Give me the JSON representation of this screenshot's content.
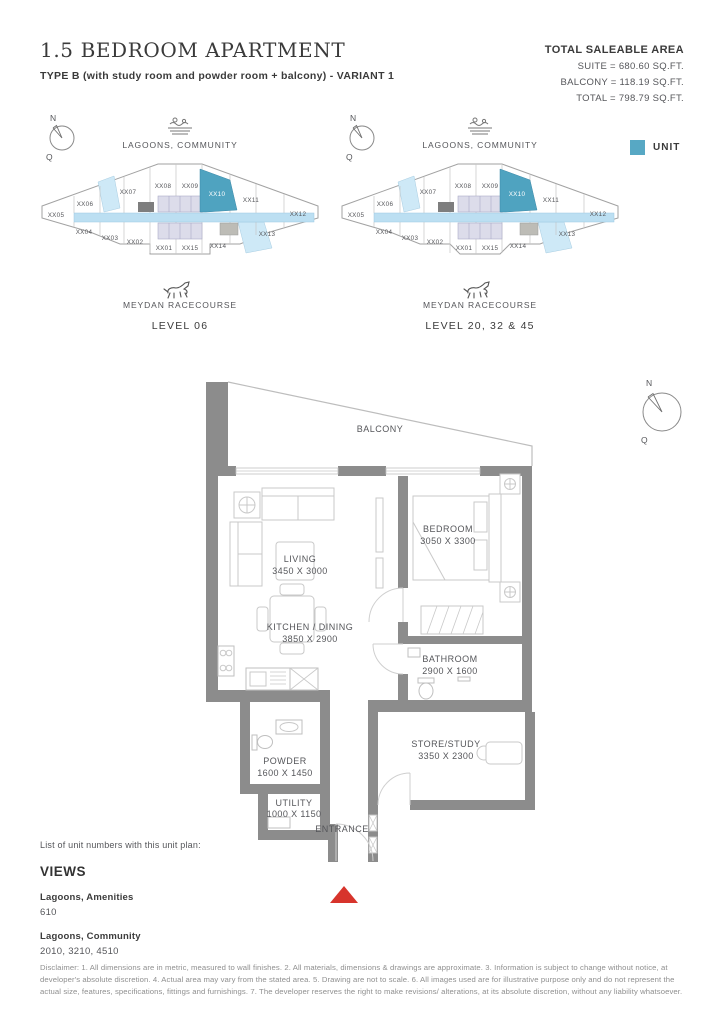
{
  "header": {
    "title": "1.5 BEDROOM APARTMENT",
    "subtitle": "TYPE B (with study room and powder room + balcony) - VARIANT 1",
    "area_heading": "TOTAL SALEABLE AREA",
    "area_lines": [
      "SUITE = 680.60 SQ.FT.",
      "BALCONY = 118.19 SQ.FT.",
      "TOTAL = 798.79 SQ.FT."
    ]
  },
  "legend": {
    "unit_label": "UNIT",
    "unit_color": "#57a8c4"
  },
  "compass": {
    "n": "N",
    "q": "Q"
  },
  "keyplans": [
    {
      "top_label": "LAGOONS, COMMUNITY",
      "bottom_label": "MEYDAN RACECOURSE",
      "level": "LEVEL 06",
      "highlighted_unit": "XX10",
      "units": [
        "XX05",
        "XX06",
        "XX07",
        "XX08",
        "XX09",
        "XX10",
        "XX11",
        "XX12",
        "XX04",
        "XX03",
        "XX02",
        "XX01",
        "XX15",
        "XX14",
        "XX13"
      ]
    },
    {
      "top_label": "LAGOONS, COMMUNITY",
      "bottom_label": "MEYDAN RACECOURSE",
      "level": "LEVEL 20, 32 & 45",
      "highlighted_unit": "XX10",
      "units": [
        "XX05",
        "XX06",
        "XX07",
        "XX08",
        "XX09",
        "XX10",
        "XX11",
        "XX12",
        "XX04",
        "XX03",
        "XX02",
        "XX01",
        "XX15",
        "XX14",
        "XX13"
      ]
    }
  ],
  "floorplan": {
    "rooms": [
      {
        "name": "BALCONY",
        "dims": ""
      },
      {
        "name": "LIVING",
        "dims": "3450 X 3000"
      },
      {
        "name": "KITCHEN / DINING",
        "dims": "3850 X 2900"
      },
      {
        "name": "BEDROOM",
        "dims": "3050 X 3300"
      },
      {
        "name": "BATHROOM",
        "dims": "2900 X 1600"
      },
      {
        "name": "STORE/STUDY",
        "dims": "3350 X 2300"
      },
      {
        "name": "POWDER",
        "dims": "1600 X 1450"
      },
      {
        "name": "UTILITY",
        "dims": "1000 X 1150"
      },
      {
        "name": "ENTRANCE",
        "dims": ""
      }
    ]
  },
  "unit_list": {
    "intro": "List of unit numbers with this unit plan:",
    "heading": "VIEWS",
    "groups": [
      {
        "view": "Lagoons, Amenities",
        "units": "610"
      },
      {
        "view": "Lagoons, Community",
        "units": "2010, 3210, 4510"
      }
    ]
  },
  "disclaimer": "Disclaimer: 1. All dimensions are in metric, measured to wall finishes. 2. All materials, dimensions & drawings are approximate. 3. Information is subject to change without notice, at developer's absolute discretion. 4. Actual area may vary from the stated area. 5. Drawing are not to scale. 6. All images used are for illustrative purpose only and do not represent the actual size, features, specifications, fittings and furnishings. 7. The developer reserves the right to make revisions/ alterations, at its absolute discretion, without any liability whatsoever."
}
